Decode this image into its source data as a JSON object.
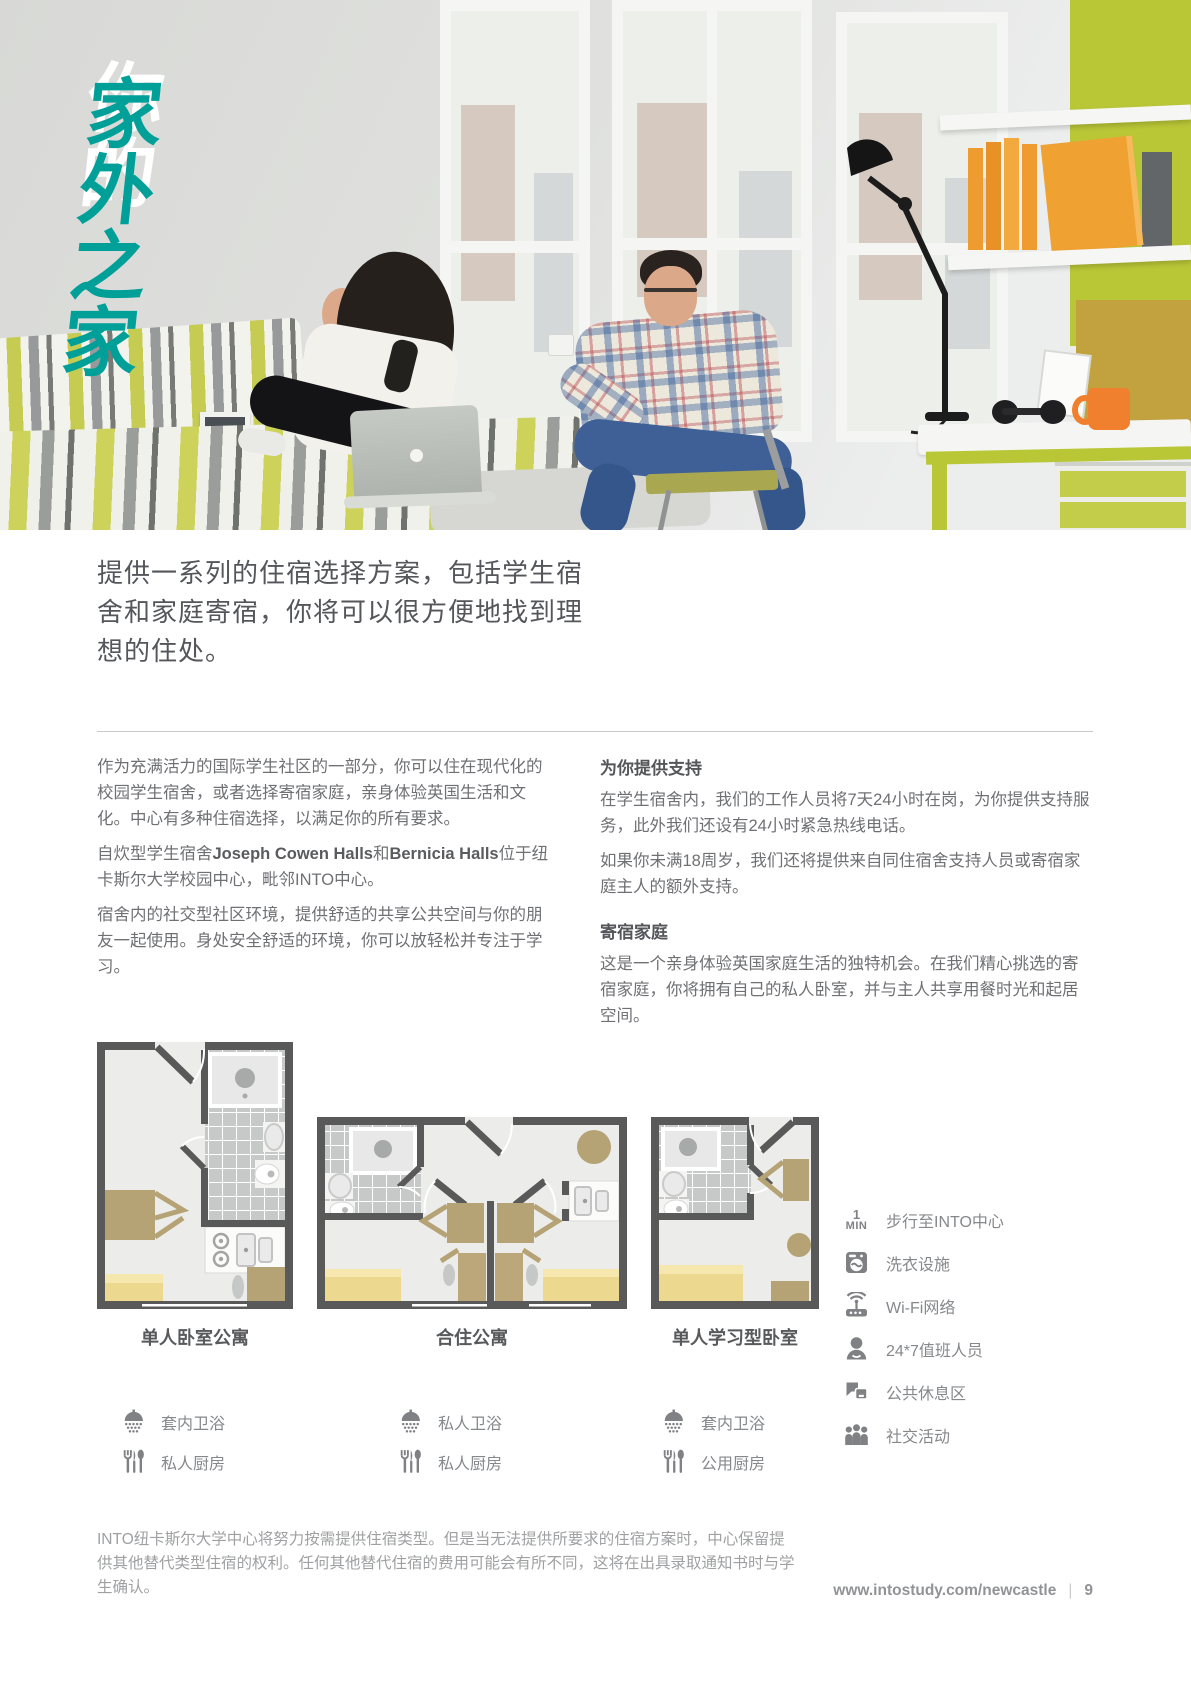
{
  "hero": {
    "title_line1": "你的",
    "title_line2": "家外之家"
  },
  "intro": "提供一系列的住宿选择方案，包括学生宿舍和家庭寄宿，你将可以很方便地找到理想的住处。",
  "left_column": {
    "para1": "作为充满活力的国际学生社区的一部分，你可以住在现代化的校园学生宿舍，或者选择寄宿家庭，亲身体验英国生活和文化。中心有多种住宿选择，以满足你的所有要求。",
    "para2_s1": "自炊型学生宿舍",
    "para2_b1": "Joseph Cowen Halls",
    "para2_s2": "和",
    "para2_b2": "Bernicia Halls",
    "para2_s3": "位于纽卡斯尔大学校园中心，毗邻INTO中心。",
    "para3": "宿舍内的社交型社区环境，提供舒适的共享公共空间与你的朋友一起使用。身处安全舒适的环境，你可以放轻松并专注于学习。"
  },
  "right_column": {
    "heading1": "为你提供支持",
    "para1": "在学生宿舍内，我们的工作人员将7天24小时在岗，为你提供支持服务，此外我们还设有24小时紧急热线电话。",
    "para2": "如果你未满18周岁，我们还将提供来自同住宿舍支持人员或寄宿家庭主人的额外支持。",
    "heading2": "寄宿家庭",
    "para3": "这是一个亲身体验英国家庭生活的独特机会。在我们精心挑选的寄宿家庭，你将拥有自己的私人卧室，并与主人共享用餐时光和起居空间。"
  },
  "floor_plans": [
    {
      "label": "单人卧室公寓",
      "features": [
        {
          "label": "套内卫浴"
        },
        {
          "label": "私人厨房"
        }
      ]
    },
    {
      "label": "合住公寓",
      "features": [
        {
          "label": "私人卫浴"
        },
        {
          "label": "私人厨房"
        }
      ]
    },
    {
      "label": "单人学习型卧室",
      "features": [
        {
          "label": "套内卫浴"
        },
        {
          "label": "公用厨房"
        }
      ]
    }
  ],
  "amenities": {
    "walk_badge_top": "1",
    "walk_badge_bottom": "MIN",
    "items": [
      {
        "label": "步行至INTO中心"
      },
      {
        "label": "洗衣设施"
      },
      {
        "label": "Wi-Fi网络"
      },
      {
        "label": "24*7值班人员"
      },
      {
        "label": "公共休息区"
      },
      {
        "label": "社交活动"
      }
    ]
  },
  "disclaimer": "INTO纽卡斯尔大学中心将努力按需提供住宿类型。但是当无法提供所要求的住宿方案时，中心保留提供其他替代类型住宿的权利。任何其他替代住宿的费用可能会有所不同，这将在出具录取通知书时与学生确认。",
  "footer": {
    "url": "www.intostudy.com/newcastle",
    "separator": "|",
    "page_number": "9"
  },
  "colors": {
    "teal": "#00a099",
    "lime": "#b9c636",
    "orange": "#efa132",
    "mustard": "#c2a23e",
    "wall_dark": "#59595a",
    "bed_yellow": "#ecd88e",
    "furniture_khaki": "#b5a375",
    "icon_gray": "#808184"
  }
}
